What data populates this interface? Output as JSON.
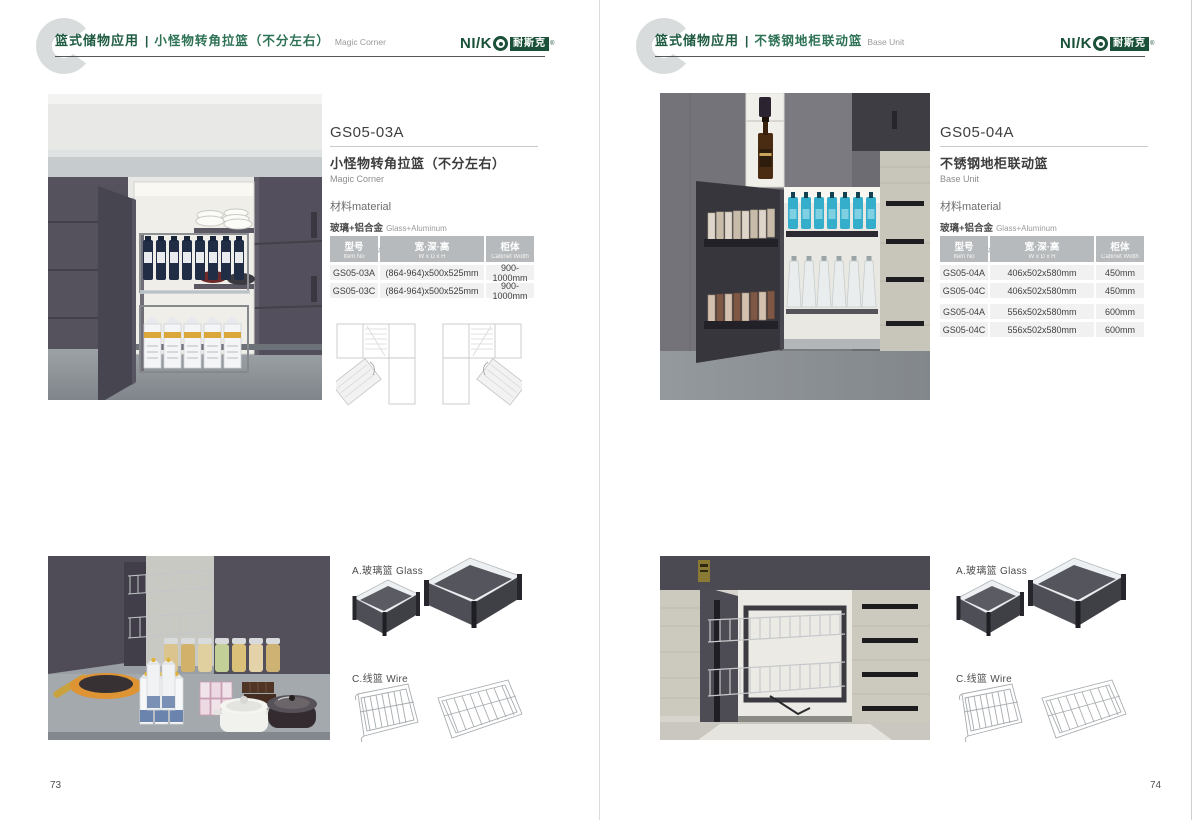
{
  "brand": {
    "wordmark": "NI/K",
    "cn": "耐斯克",
    "reg": "®"
  },
  "colors": {
    "brand_green": "#1a5138",
    "title_green": "#2d7254",
    "table_header_bg": "#b7babc",
    "table_row_bg": "#f1f1f2"
  },
  "pages": [
    {
      "page_number": "73",
      "header": {
        "category": "篮式储物应用",
        "divider": "|",
        "title_cn": "小怪物转角拉篮（不分左右）",
        "title_en": "Magic Corner"
      },
      "product": {
        "model": "GS05-03A",
        "name_cn": "小怪物转角拉篮（不分左右）",
        "name_en": "Magic Corner",
        "material_label": "材料material",
        "materials": [
          {
            "cn": "玻璃+铝合金",
            "en": "Glass+Aluminum"
          },
          {
            "cn": "不锈钢/铁",
            "en": "Stainless SteeL/Iron"
          }
        ]
      },
      "table": {
        "headers": [
          {
            "cn": "型号",
            "en": "Item No"
          },
          {
            "cn": "宽·深·高",
            "en": "W x D x H"
          },
          {
            "cn": "柜体",
            "en": "Cabinet Width"
          }
        ],
        "rows": [
          [
            "GS05-03A",
            "(864-964)x500x525mm",
            "900-1000mm"
          ],
          [
            "GS05-03C",
            "(864-964)x500x525mm",
            "900-1000mm"
          ]
        ]
      },
      "accessories": {
        "glass_label": "A.玻璃篮 Glass",
        "wire_label": "C.线篮 Wire"
      }
    },
    {
      "page_number": "74",
      "header": {
        "category": "篮式储物应用",
        "divider": "|",
        "title_cn": "不锈钢地柜联动篮",
        "title_en": "Base Unit"
      },
      "product": {
        "model": "GS05-04A",
        "name_cn": "不锈钢地柜联动篮",
        "name_en": "Base Unit",
        "material_label": "材料material",
        "materials": [
          {
            "cn": "玻璃+铝合金",
            "en": "Glass+Aluminum"
          },
          {
            "cn": "不锈钢/铁",
            "en": "Stainless SteeL/Iron"
          }
        ]
      },
      "table": {
        "headers": [
          {
            "cn": "型号",
            "en": "Item No"
          },
          {
            "cn": "宽·深·高",
            "en": "W x D x H"
          },
          {
            "cn": "柜体",
            "en": "Cabinet Width"
          }
        ],
        "rows": [
          [
            "GS05-04A",
            "406x502x580mm",
            "450mm"
          ],
          [
            "GS05-04C",
            "406x502x580mm",
            "450mm"
          ],
          [
            "GS05-04A",
            "556x502x580mm",
            "600mm"
          ],
          [
            "GS05-04C",
            "556x502x580mm",
            "600mm"
          ]
        ]
      },
      "accessories": {
        "glass_label": "A.玻璃篮 Glass",
        "wire_label": "C.线篮 Wire"
      }
    }
  ]
}
